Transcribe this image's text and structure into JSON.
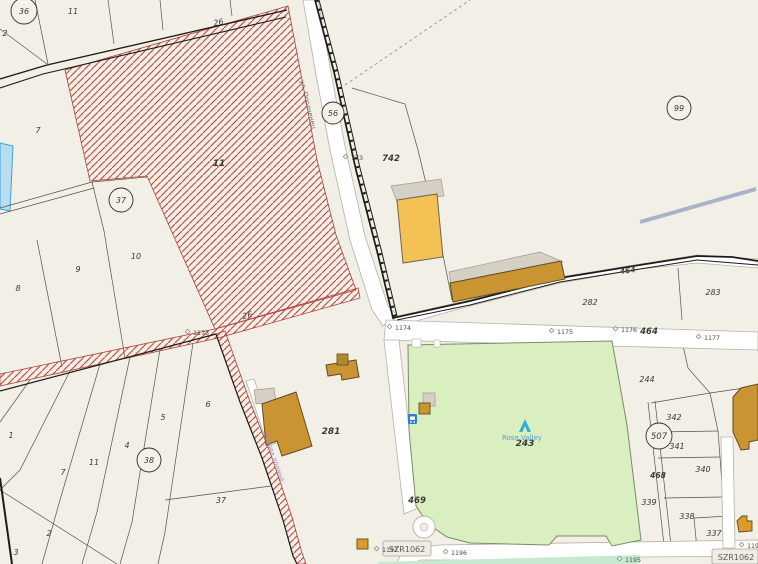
{
  "map_type": "cadastral-parcel-map",
  "colors": {
    "map_bg": "#f2efe6",
    "hatch_red": "#c0504a",
    "park_green": "#d9efbf",
    "building_amber": "#f4c254",
    "building_gold": "#ca9432",
    "road_white": "#ffffff",
    "water_blue_parcel": "#b8ddf1",
    "poi_teal": "#35aecb",
    "park_label_blue": "#5b9bd5"
  },
  "circled_labels": {
    "n36": "36",
    "n37": "37",
    "n38": "38",
    "n56": "56",
    "n99": "99",
    "n507": "507"
  },
  "parcel_labels": {
    "top_11": "11",
    "top_2": "2",
    "top_26": "26",
    "left_7": "7",
    "left_9": "9",
    "left_10": "10",
    "left_8": "8",
    "hatch_11": "11",
    "mid_26": "26",
    "bl_1": "1",
    "bl_7": "7",
    "bl_11": "11",
    "bl_4": "4",
    "bl_5": "5",
    "bl_6": "6",
    "bl_2": "2",
    "bl_37": "37",
    "bl_3": "3",
    "c_281": "281",
    "r_282": "282",
    "r_283": "283",
    "r_244": "244",
    "r_243": "243",
    "r_342": "342",
    "r_341": "341",
    "r_340": "340",
    "r_339": "339",
    "r_338": "338",
    "r_337": "337",
    "r_468": "468"
  },
  "road_labels": {
    "n742": "742",
    "n464": "464",
    "n464_diag": "464",
    "n469": "469"
  },
  "survey_points": {
    "p773": "773",
    "p1173": "1173",
    "p1174": "1174",
    "p1175": "1175",
    "p1176": "1176",
    "p1177": "1177",
    "p1194": "1194",
    "p1195": "1195",
    "p1196": "1196",
    "p1197": "1197"
  },
  "badges": {
    "left": "SZR1062",
    "right": "SZR1062"
  },
  "streets": {
    "north_street": "ул. Ополченец",
    "south_track": "Розова долина"
  },
  "park": {
    "name": "Rose Valley"
  }
}
